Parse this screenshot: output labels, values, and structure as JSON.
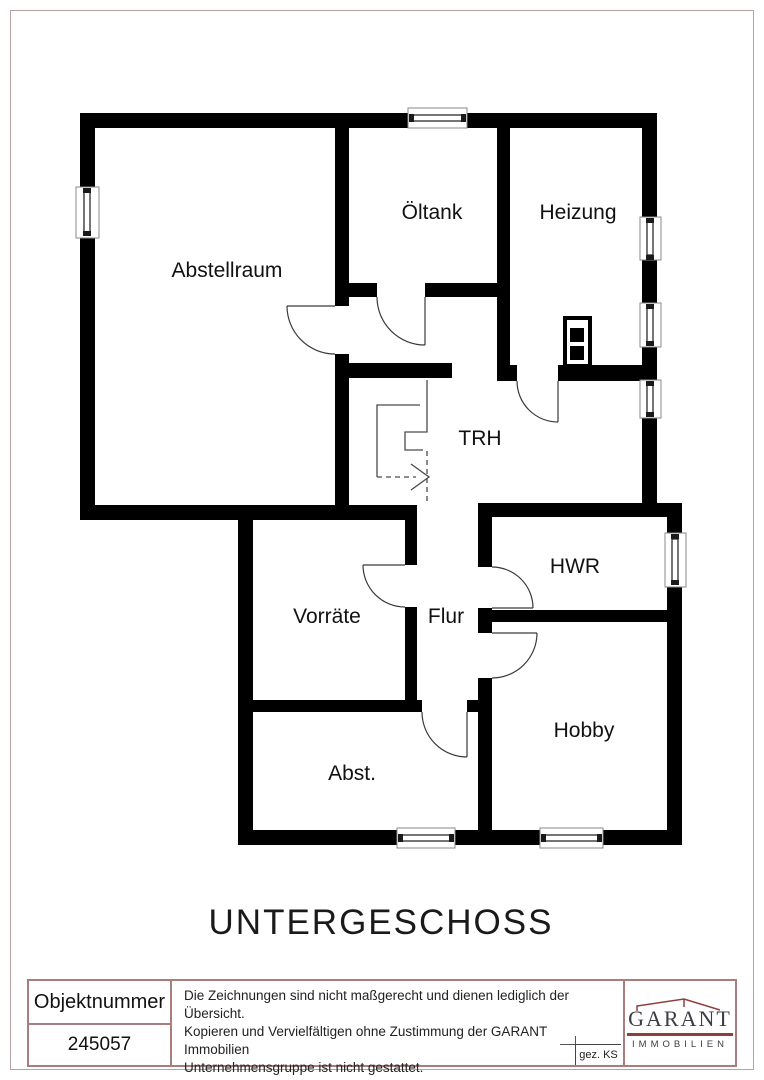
{
  "colors": {
    "wall": "#000000",
    "table_border": "#a87d7d",
    "page_border": "#b5a2a2",
    "logo_accent": "#8e3e3e",
    "logo_text": "#3c3c44"
  },
  "plan": {
    "title": "UNTERGESCHOSS",
    "rooms": [
      {
        "label": "Abstellraum"
      },
      {
        "label": "Öltank"
      },
      {
        "label": "Heizung"
      },
      {
        "label": "TRH"
      },
      {
        "label": "Vorräte"
      },
      {
        "label": "Flur"
      },
      {
        "label": "HWR"
      },
      {
        "label": "Hobby"
      },
      {
        "label": "Abst."
      }
    ]
  },
  "title_block": {
    "object_number_label": "Objektnummer",
    "object_number_value": "245057",
    "disclaimer_lines": [
      "Die Zeichnungen sind nicht maßgerecht und dienen lediglich der Übersicht.",
      "Kopieren und Vervielfältigen ohne Zustimmung der GARANT Immobilien",
      "Unternehmensgruppe ist nicht gestattet."
    ],
    "drawn_by": "gez. KS",
    "logo": {
      "name": "GARANT",
      "subtitle": "IMMOBILIEN"
    }
  }
}
